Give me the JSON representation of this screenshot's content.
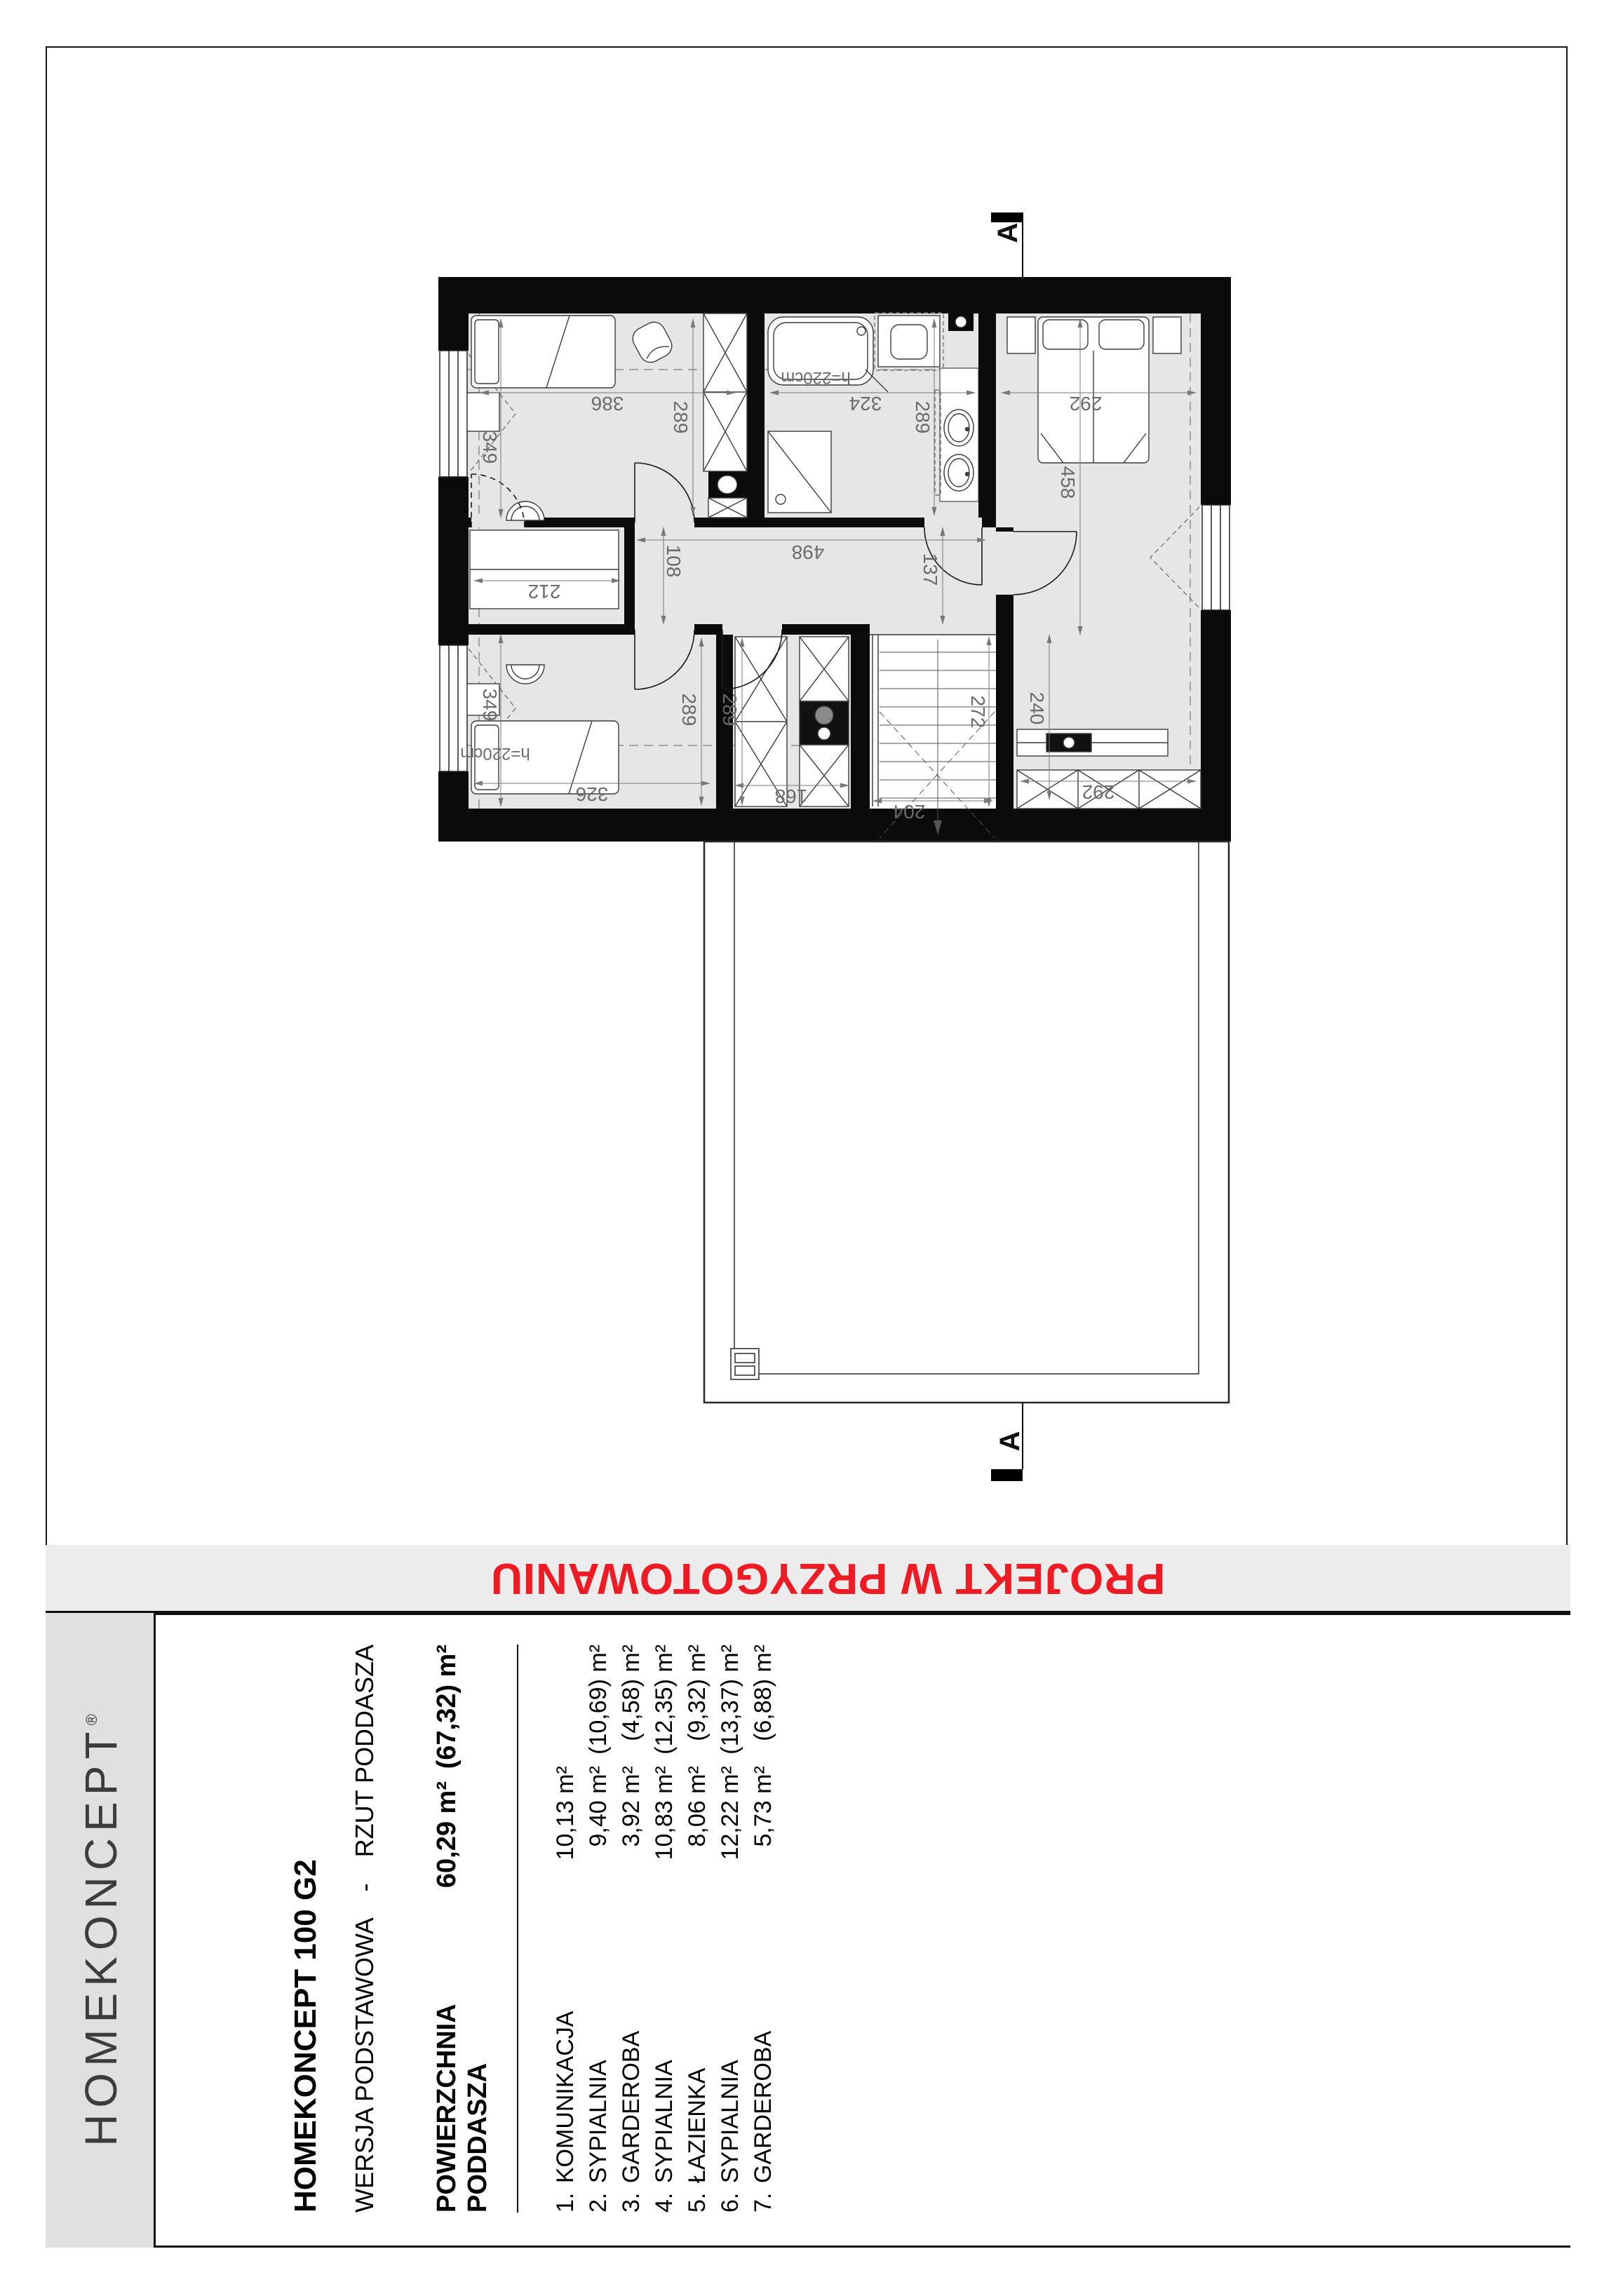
{
  "banner": {
    "text": "PROJEKT W PRZYGOTOWANIU",
    "color": "#ED1C24"
  },
  "logo": {
    "brand": "HOMEKONCEPT",
    "registered": "®"
  },
  "title_block": {
    "project": "HOMEKONCEPT 100 G2",
    "version": "WERSJA PODSTAWOWA",
    "separator": "-",
    "drawing": "RZUT PODDASZA",
    "area_label": "POWIERZCHNIA PODDASZA",
    "area_value": "60,29 m²",
    "area_gross": "(67,32) m²",
    "rooms": [
      {
        "no": "1.",
        "name": "KOMUNIKACJA",
        "area": "10,13 m²",
        "gross": ""
      },
      {
        "no": "2.",
        "name": "SYPIALNIA",
        "area": "9,40 m²",
        "gross": "(10,69) m²"
      },
      {
        "no": "3.",
        "name": "GARDEROBA",
        "area": "3,92 m²",
        "gross": "(4,58) m²"
      },
      {
        "no": "4.",
        "name": "SYPIALNIA",
        "area": "10,83 m²",
        "gross": "(12,35) m²"
      },
      {
        "no": "5.",
        "name": "ŁAZIENKA",
        "area": "8,06 m²",
        "gross": "(9,32) m²"
      },
      {
        "no": "6.",
        "name": "SYPIALNIA",
        "area": "12,22 m²",
        "gross": "(13,37) m²"
      },
      {
        "no": "7.",
        "name": "GARDEROBA",
        "area": "5,73 m²",
        "gross": "(6,88) m²"
      }
    ]
  },
  "plan": {
    "section_marker_top": "A",
    "section_marker_bottom": "A",
    "dims": {
      "bedroom_tl_width": "386",
      "bedroom_tl_depth": "289",
      "window_tl": "349",
      "bath_width": "324",
      "bath_depth": "289",
      "bedroom_r_width": "292",
      "bedroom_r_depth": "458",
      "hall_width": "498",
      "hall_depth_left": "108",
      "hall_depth_right": "137",
      "garderoba_left_width": "212",
      "window_bl": "349",
      "bedroom_bl_width": "326",
      "bedroom_bl_depth": "289",
      "garderoba_center_depth": "289",
      "garderoba_center_width": "168",
      "stairs_width": "204",
      "stairs_depth": "272",
      "wardrobe_r_depth": "240",
      "wardrobe_r_width": "292",
      "headroom_bath": "h=220cm",
      "headroom_bedroom": "h=220cm"
    }
  }
}
